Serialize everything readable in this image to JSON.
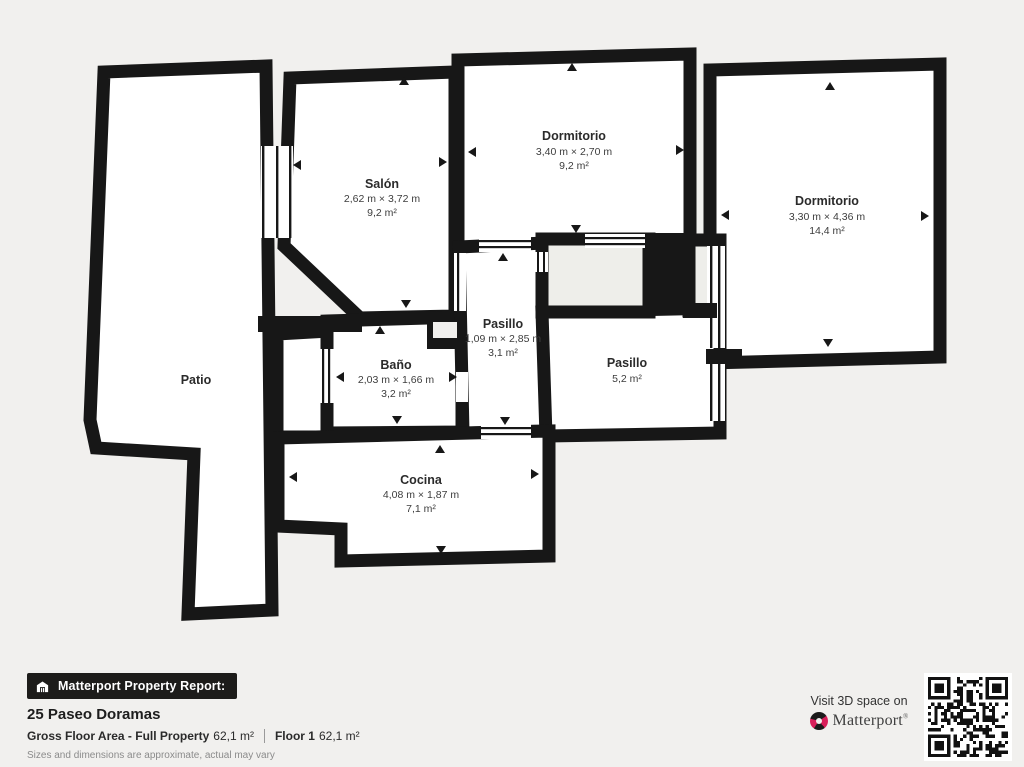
{
  "colors": {
    "background": "#f1f0ee",
    "wall": "#171717",
    "room_fill": "#ffffff",
    "closet_fill": "#eeeeea",
    "brand_pink": "#d81f5a",
    "badge_bg": "#1d1c1a"
  },
  "plan": {
    "rooms": [
      {
        "id": "patio",
        "name": "Patio",
        "dims": "",
        "area": ""
      },
      {
        "id": "salon",
        "name": "Salón",
        "dims": "2,62 m × 3,72 m",
        "area": "9,2 m²"
      },
      {
        "id": "dormitorio1",
        "name": "Dormitorio",
        "dims": "3,40 m × 2,70 m",
        "area": "9,2 m²"
      },
      {
        "id": "dormitorio2",
        "name": "Dormitorio",
        "dims": "3,30 m × 4,36 m",
        "area": "14,4 m²"
      },
      {
        "id": "pasillo1",
        "name": "Pasillo",
        "dims": "1,09 m × 2,85 m",
        "area": "3,1 m²"
      },
      {
        "id": "bano",
        "name": "Baño",
        "dims": "2,03 m × 1,66 m",
        "area": "3,2 m²"
      },
      {
        "id": "pasillo2",
        "name": "Pasillo",
        "dims": "",
        "area": "5,2 m²"
      },
      {
        "id": "cocina",
        "name": "Cocina",
        "dims": "4,08 m × 1,87 m",
        "area": "7,1 m²"
      }
    ]
  },
  "footer": {
    "report_badge": "Matterport Property Report:",
    "address": "25 Paseo Doramas",
    "gfa_label": "Gross Floor Area - Full Property",
    "gfa_value": "62,1 m²",
    "floor_label": "Floor 1",
    "floor_value": "62,1 m²",
    "disclaimer": "Sizes and dimensions are approximate, actual may vary"
  },
  "cta": {
    "visit_text": "Visit 3D space on",
    "brand": "Matterport",
    "trademark": "®"
  }
}
